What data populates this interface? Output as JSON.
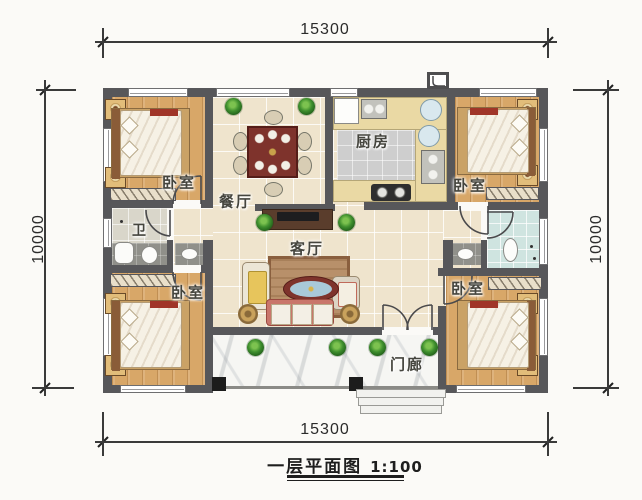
{
  "title": {
    "text": "一层平面图",
    "scale": "1:100"
  },
  "dimensions": {
    "top": "15300",
    "bottom": "15300",
    "left": "10000",
    "right": "10000"
  },
  "rooms": {
    "bedroom_top_left": {
      "label": "卧室"
    },
    "bedroom_top_right": {
      "label": "卧室"
    },
    "bedroom_bottom_left": {
      "label": "卧室"
    },
    "bedroom_bottom_right": {
      "label": "卧室"
    },
    "dining": {
      "label": "餐厅"
    },
    "kitchen": {
      "label": "厨房"
    },
    "living": {
      "label": "客厅"
    },
    "bathroom": {
      "label": "卫"
    },
    "porch": {
      "label": "门廊"
    }
  },
  "colors": {
    "wall": "#57575a",
    "wood_floor": "#d8a768",
    "tile_floor": "#efe4cd",
    "marble_floor": "#f6f6f3",
    "bath_teal": "#cfe4e0",
    "table_red": "#7e332c",
    "plant_green": "#2e6b22",
    "column_black": "#1c1c1c"
  }
}
